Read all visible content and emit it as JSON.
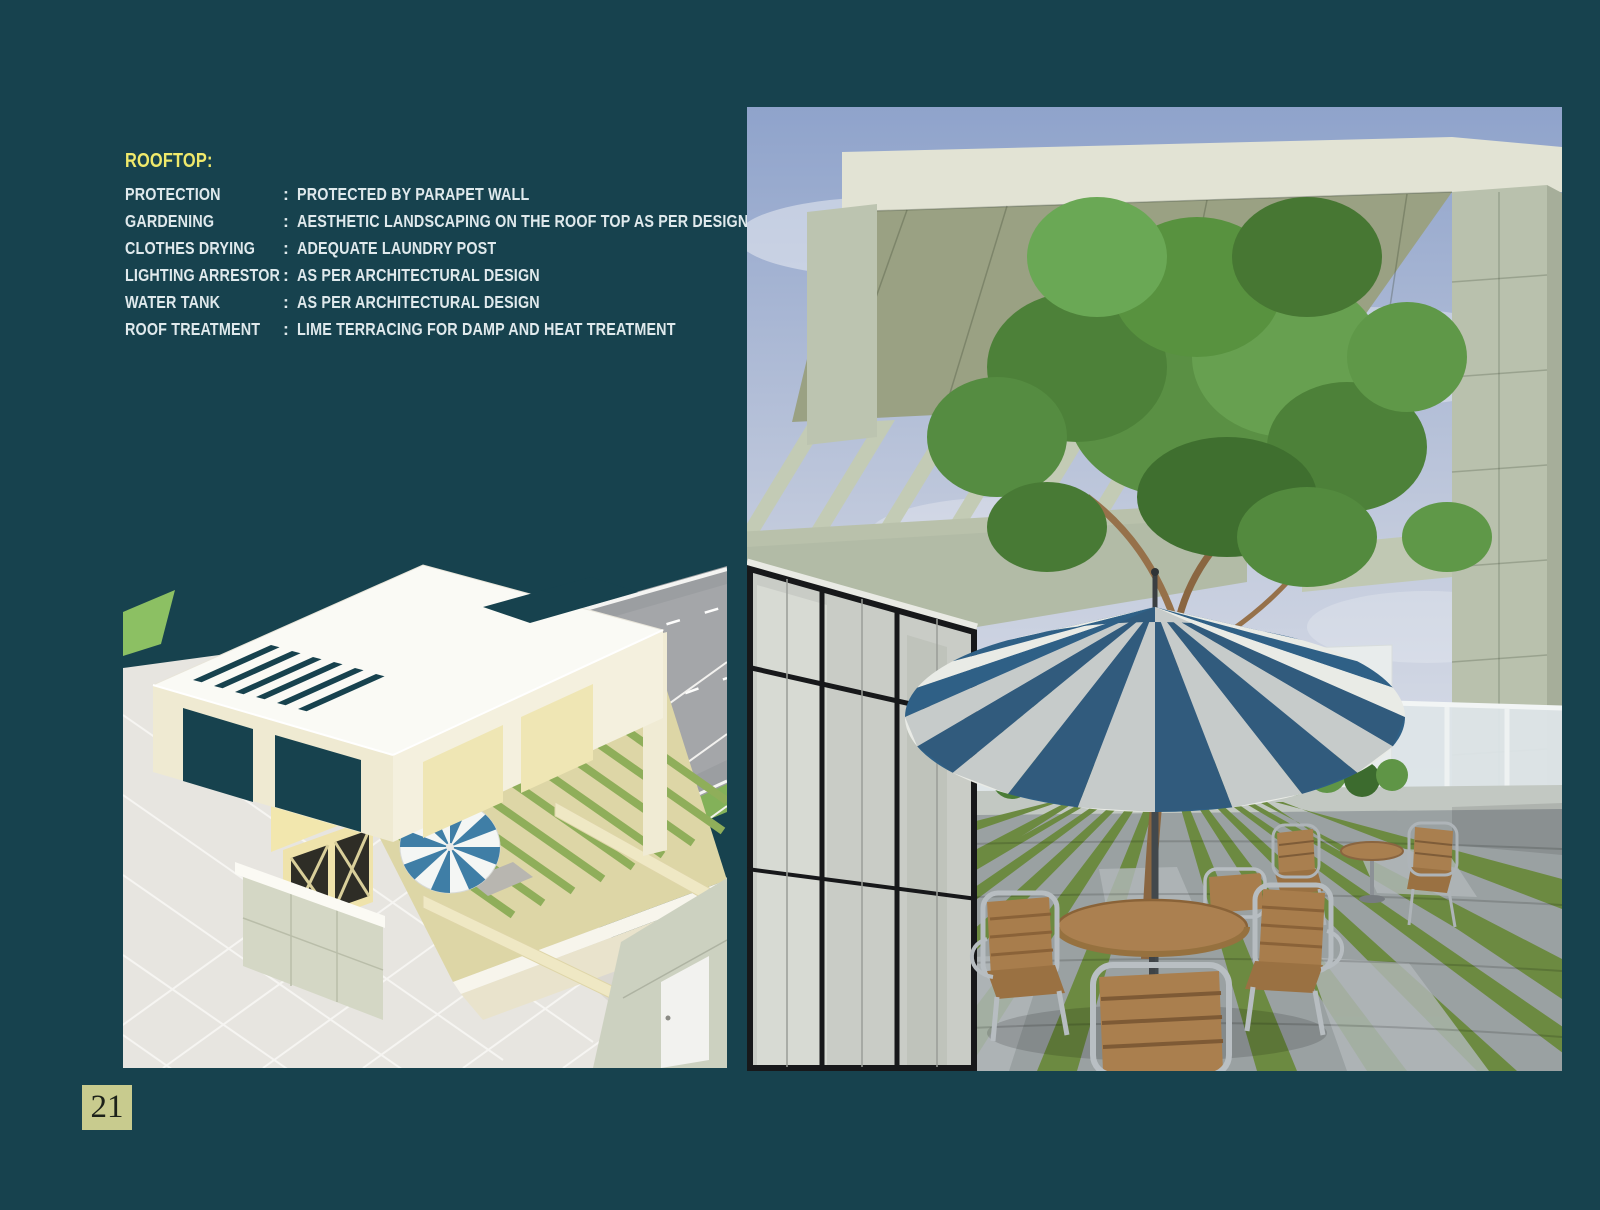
{
  "page": {
    "background_color": "#17424e",
    "page_number": "21",
    "page_number_box_color": "#c8cb8e"
  },
  "specs": {
    "title": "ROOFTOP:",
    "title_color": "#f0e96b",
    "text_color": "#dfe9ec",
    "colon": ":",
    "rows": [
      {
        "label": "PROTECTION",
        "value": "PROTECTED BY PARAPET WALL"
      },
      {
        "label": "GARDENING",
        "value": "AESTHETIC LANDSCAPING ON THE ROOF TOP AS PER DESIGN"
      },
      {
        "label": "CLOTHES DRYING",
        "value": "ADEQUATE LAUNDRY POST"
      },
      {
        "label": "LIGHTING ARRESTOR",
        "value": "AS PER ARCHITECTURAL DESIGN"
      },
      {
        "label": "WATER TANK",
        "value": "AS PER ARCHITECTURAL DESIGN"
      },
      {
        "label": "ROOF TREATMENT",
        "value": "LIME TERRACING FOR DAMP AND HEAT TREATMENT"
      }
    ]
  },
  "figures": {
    "left": {
      "name": "rooftop-isometric-render",
      "description": "Aerial isometric 3D render of rooftop: white pergola frame with slatted roof, courtyard with tree, hedge and blue-white striped umbrella, tiled plaza and adjacent grey road"
    },
    "right": {
      "name": "rooftop-terrace-render",
      "description": "Eye-level 3D render of rooftop terrace: concrete pergola, glass facade, tree through blue-white striped umbrella, teak chairs and tables, grass-jointed paver floor"
    },
    "colors": {
      "umbrella_blue": "#2f6086",
      "umbrella_white": "#e9ebe6",
      "concrete": "#b9c1ad",
      "foliage_green": "#5a9044",
      "moss_green": "#6c8a41",
      "sky_blue": "#8fa3cb",
      "teak_wood": "#a87e4e"
    }
  }
}
